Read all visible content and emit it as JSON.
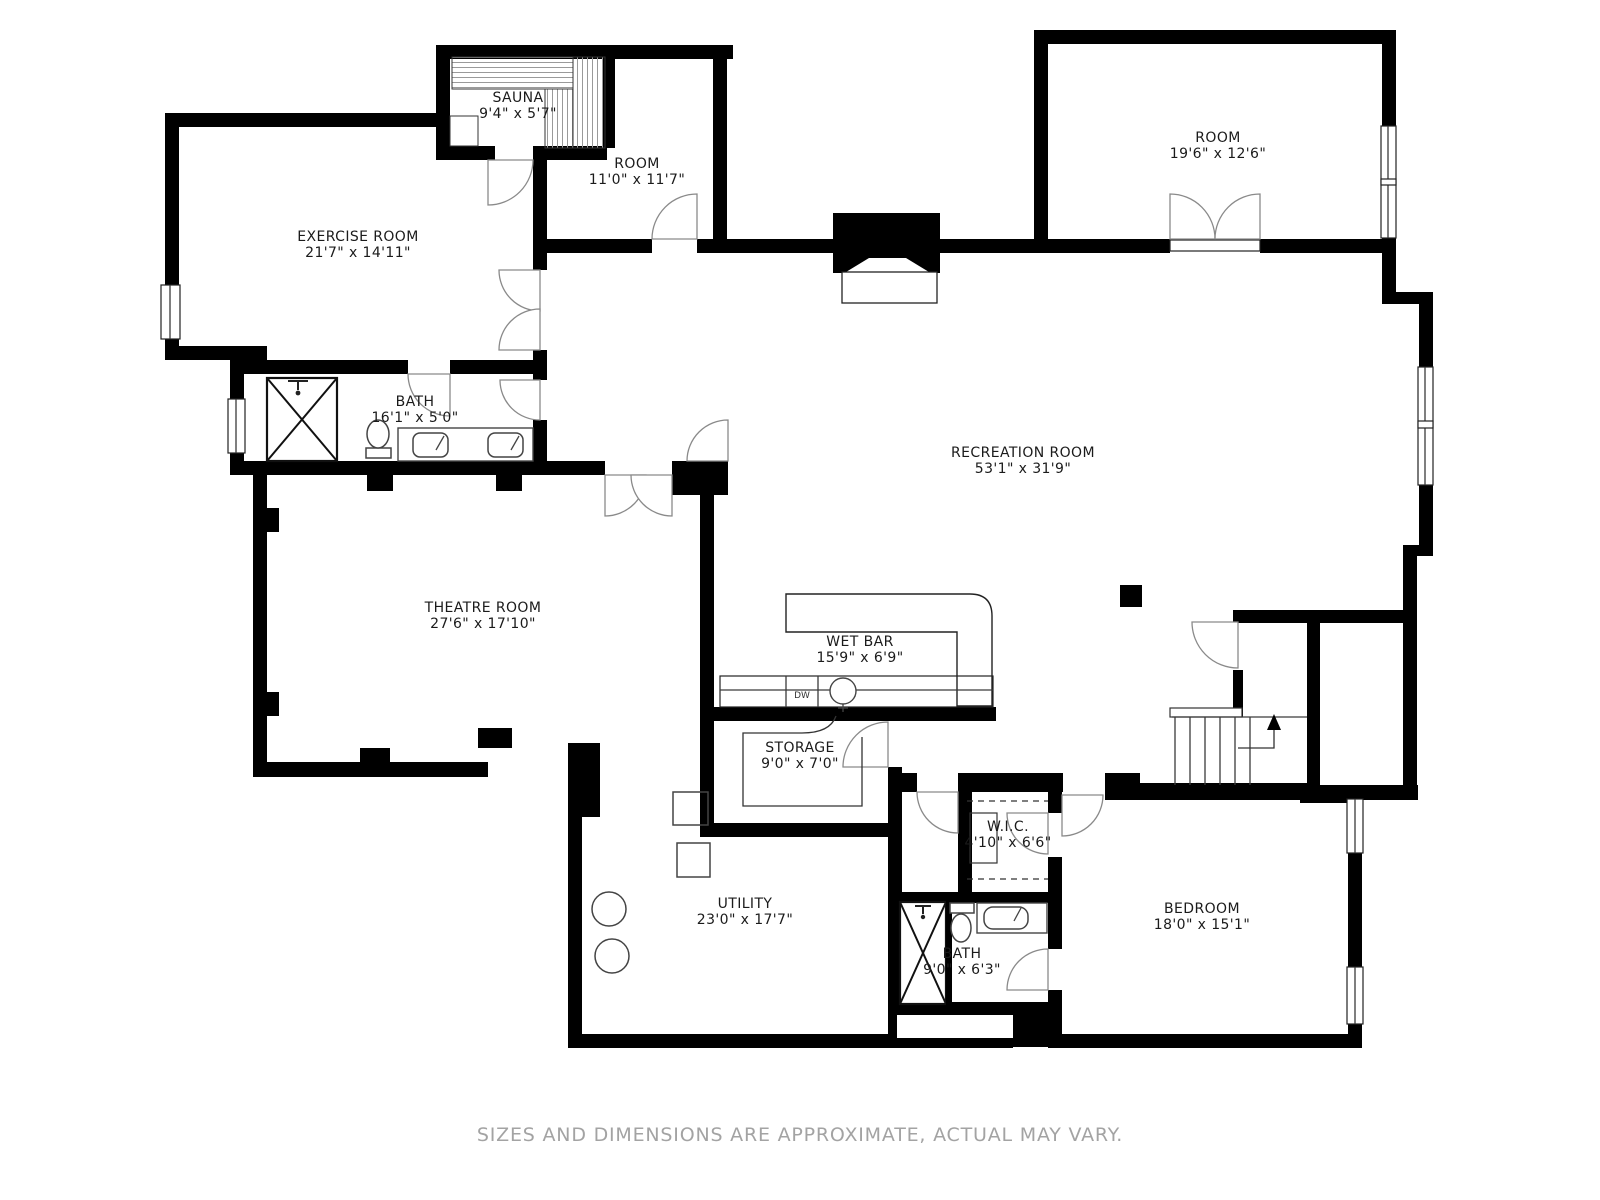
{
  "rooms": [
    {
      "name": "SAUNA",
      "dims": "9'4\" x 5'7\""
    },
    {
      "name": "ROOM",
      "dims": "11'0\" x 11'7\""
    },
    {
      "name": "ROOM",
      "dims": "19'6\" x 12'6\""
    },
    {
      "name": "EXERCISE ROOM",
      "dims": "21'7\" x 14'11\""
    },
    {
      "name": "BATH",
      "dims": "16'1\" x 5'0\""
    },
    {
      "name": "RECREATION ROOM",
      "dims": "53'1\" x 31'9\""
    },
    {
      "name": "THEATRE ROOM",
      "dims": "27'6\" x 17'10\""
    },
    {
      "name": "WET BAR",
      "dims": "15'9\" x 6'9\""
    },
    {
      "name": "STORAGE",
      "dims": "9'0\" x 7'0\""
    },
    {
      "name": "UTILITY",
      "dims": "23'0\" x 17'7\""
    },
    {
      "name": "W.I.C.",
      "dims": "4'10\" x 6'6\""
    },
    {
      "name": "BATH",
      "dims": "9'0\" x 6'3\""
    },
    {
      "name": "BEDROOM",
      "dims": "18'0\" x 15'1\""
    }
  ],
  "fixtures": {
    "dishwasher_label": "DW"
  },
  "footer": {
    "disclaimer": "SIZES AND DIMENSIONS ARE APPROXIMATE, ACTUAL MAY VARY."
  },
  "colors": {
    "wall": "#000000",
    "door_line": "#8a8a8a",
    "footer_text": "#a3a3a3"
  }
}
